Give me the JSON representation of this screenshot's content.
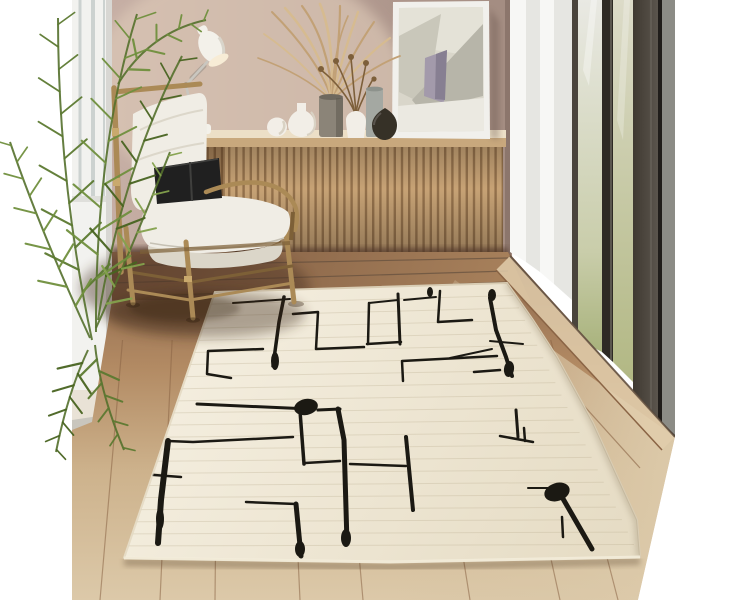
{
  "meta": {
    "alt": "Interior product photo: cream rug with black abstract line pattern on wood floor, rattan armchair with white cushions and black pillow, slatted oak sideboard with vases, dried pampas grass, leaning abstract art frame, desk lamp, palm plant, and floor-to-ceiling glass doors"
  },
  "palette": {
    "band": "#ffffff",
    "wall1": "#c9b2a8",
    "wall2": "#b59d93",
    "wall3": "#a48d82",
    "wallGlow": "#decab8",
    "pillar": "#f2f2ef",
    "pillarShade": "#d8d7d3",
    "mullion": "#ccd2d0",
    "baseboard": "#e6ddd0",
    "slatLight": "#cfa97a",
    "slatDark": "#9a764f",
    "counterTop": "#ecdfc7",
    "counterEdge": "#c8a87d",
    "boardShadow": "#53392a",
    "floorA": "#8a654a",
    "floorB": "#b28a63",
    "floorC": "#cdb28c",
    "floorD": "#dcc9a9",
    "backA": "#7c5940",
    "backB": "#a9825c",
    "seam": "#8a6445",
    "seamDark": "#59483a",
    "track": "#e0cdab",
    "rugA": "#f4eedf",
    "rugB": "#e5dbc3",
    "rugEdge": "#d9cdb4",
    "rugPile": "#f4eedd",
    "ink": "#1b1913",
    "weave": "#b9ac8e",
    "curtain1": "#f7f7f5",
    "curtain2": "#e6e6e2",
    "frameDark": "#2e2a24",
    "frameMid": "#4a443c",
    "frameLight": "#6e6960",
    "glass1a": "#e9e9e3",
    "glass1b": "#a9b37d",
    "glass2a": "#dcdbc8",
    "glass2b": "#b2b884",
    "panelA": "#3f3931",
    "panelB": "#5b554d",
    "grayStrip": "#8c8c86",
    "blackLine": "#201d1a",
    "rattan": "#ab8a56",
    "rattanDark": "#7d6037",
    "binding": "#c9a96d",
    "cushion": "#f0ede5",
    "cushionShade": "#dbd6c9",
    "pillowBlack": "#202020",
    "pillowHi": "#3f3f3d",
    "leaf1": "#5c7a31",
    "leaf2": "#70903e",
    "leaf3": "#486420",
    "leaf4": "#84a24d",
    "stemGreen": "#54702c",
    "lampShade": "#f3f1ea",
    "lampShadeShade": "#d9d5cb",
    "lampInner": "#f7ecd6",
    "lampArm": "#c9c6bf",
    "lampArmDark": "#8e8a82",
    "artFrame": "#f1f0ec",
    "artBg": "#d9d6ca",
    "artLight": "#e4e2d7",
    "artGray": "#b7b5a9",
    "artGray2": "#c9c7ba",
    "artLav": "#a39aab",
    "artLavDark": "#877f92",
    "artWhite": "#ebe9e1",
    "vaseWhite": "#f2eee7",
    "vaseWhiteShade": "#d9d2c4",
    "vaseGray": "#8b8478",
    "vaseGrayTop": "#6e685e",
    "vaseBlue": "#a4a8a2",
    "vaseBlueTop": "#8d928c",
    "vaseDark": "#363127",
    "vaseDarkHi": "#5a554e",
    "pampas": "#c2a176",
    "pampasLight": "#d6bb90",
    "stemBrown": "#7d5f3a"
  },
  "rug": {
    "corners": {
      "tl": [
        215,
        292
      ],
      "tr": [
        507,
        283
      ],
      "br": [
        640,
        557
      ],
      "bl": [
        124,
        558
      ]
    },
    "pattern": {
      "lines": [
        {
          "w": 2,
          "pts": [
            [
              233,
              303
            ],
            [
              290,
              299
            ]
          ]
        },
        {
          "w": 3.5,
          "pts": [
            [
              284,
              297
            ],
            [
              279,
              322
            ],
            [
              273,
              366
            ]
          ]
        },
        {
          "w": 2.5,
          "pts": [
            [
              293,
              314
            ],
            [
              318,
              312
            ],
            [
              316,
              349
            ],
            [
              364,
              347
            ]
          ]
        },
        {
          "w": 2.5,
          "pts": [
            [
              369,
              303
            ],
            [
              368,
              344
            ]
          ]
        },
        {
          "w": 2,
          "pts": [
            [
              369,
              303
            ],
            [
              398,
              300
            ]
          ]
        },
        {
          "w": 3,
          "pts": [
            [
              398,
              294
            ],
            [
              400,
              344
            ]
          ]
        },
        {
          "w": 2.5,
          "pts": [
            [
              367,
              344
            ],
            [
              401,
              342
            ]
          ]
        },
        {
          "w": 2,
          "pts": [
            [
              404,
              300
            ],
            [
              436,
              297
            ]
          ]
        },
        {
          "w": 2.5,
          "pts": [
            [
              440,
              291
            ],
            [
              438,
              322
            ],
            [
              472,
              320
            ]
          ]
        },
        {
          "w": 4,
          "pts": [
            [
              490,
              298
            ],
            [
              496,
              330
            ],
            [
              506,
              357
            ],
            [
              512,
              376
            ]
          ]
        },
        {
          "w": 2.5,
          "pts": [
            [
              474,
              372
            ],
            [
              500,
              370
            ]
          ]
        },
        {
          "w": 2,
          "pts": [
            [
              450,
              358
            ],
            [
              492,
              349
            ]
          ]
        },
        {
          "w": 2,
          "pts": [
            [
              490,
              341
            ],
            [
              523,
              344
            ]
          ]
        },
        {
          "w": 2.5,
          "pts": [
            [
              403,
              381
            ],
            [
              402,
              361
            ],
            [
              497,
              356
            ]
          ]
        },
        {
          "w": 2.5,
          "pts": [
            [
              263,
              349
            ],
            [
              208,
              351
            ],
            [
              207,
              374
            ],
            [
              231,
              378
            ]
          ]
        },
        {
          "w": 3,
          "pts": [
            [
              197,
              404
            ],
            [
              310,
              409
            ]
          ]
        },
        {
          "w": 3,
          "pts": [
            [
              318,
              410
            ],
            [
              340,
              409
            ]
          ]
        },
        {
          "w": 5,
          "pts": [
            [
              338,
              409
            ],
            [
              344,
              440
            ],
            [
              347,
              543
            ]
          ]
        },
        {
          "w": 3.5,
          "pts": [
            [
              300,
              411
            ],
            [
              304,
              464
            ]
          ]
        },
        {
          "w": 2.5,
          "pts": [
            [
              305,
              463
            ],
            [
              340,
              461
            ]
          ]
        },
        {
          "w": 2.5,
          "pts": [
            [
              168,
              441
            ],
            [
              193,
              442
            ],
            [
              293,
              437
            ]
          ]
        },
        {
          "w": 6,
          "pts": [
            [
              168,
              441
            ],
            [
              161,
              500
            ],
            [
              158,
              543
            ]
          ]
        },
        {
          "w": 2.5,
          "pts": [
            [
              142,
              486
            ],
            [
              141,
              474
            ],
            [
              181,
              477
            ]
          ]
        },
        {
          "w": 2.5,
          "pts": [
            [
              246,
              502
            ],
            [
              296,
              504
            ]
          ]
        },
        {
          "w": 5,
          "pts": [
            [
              296,
              504
            ],
            [
              301,
              556
            ]
          ]
        },
        {
          "w": 2.5,
          "pts": [
            [
              350,
              464
            ],
            [
              406,
              466
            ]
          ]
        },
        {
          "w": 4,
          "pts": [
            [
              406,
              437
            ],
            [
              413,
              510
            ]
          ]
        },
        {
          "w": 2.5,
          "pts": [
            [
              524,
              428
            ],
            [
              525,
              441
            ]
          ]
        },
        {
          "w": 2.5,
          "pts": [
            [
              500,
              436
            ],
            [
              533,
              442
            ]
          ]
        },
        {
          "w": 3,
          "pts": [
            [
              516,
              410
            ],
            [
              518,
              437
            ]
          ]
        },
        {
          "w": 5,
          "pts": [
            [
              562,
              497
            ],
            [
              592,
              549
            ]
          ]
        },
        {
          "w": 2,
          "pts": [
            [
              528,
              488
            ],
            [
              548,
              488
            ]
          ]
        },
        {
          "w": 2.5,
          "pts": [
            [
              562,
              517
            ],
            [
              563,
              537
            ]
          ]
        }
      ],
      "blobs": [
        {
          "cx": 275,
          "cy": 361,
          "rx": 4,
          "ry": 9,
          "rot": 0
        },
        {
          "cx": 509,
          "cy": 369,
          "rx": 5,
          "ry": 8,
          "rot": 8
        },
        {
          "cx": 492,
          "cy": 295,
          "rx": 4,
          "ry": 6,
          "rot": 0
        },
        {
          "cx": 306,
          "cy": 407,
          "rx": 12,
          "ry": 8,
          "rot": -12
        },
        {
          "cx": 346,
          "cy": 538,
          "rx": 5,
          "ry": 9,
          "rot": 0
        },
        {
          "cx": 160,
          "cy": 519,
          "rx": 4,
          "ry": 11,
          "rot": 0
        },
        {
          "cx": 300,
          "cy": 549,
          "rx": 5,
          "ry": 8,
          "rot": 0
        },
        {
          "cx": 557,
          "cy": 492,
          "rx": 13,
          "ry": 9,
          "rot": -18
        },
        {
          "cx": 430,
          "cy": 292,
          "rx": 3,
          "ry": 5,
          "rot": 0
        }
      ]
    },
    "weave_count": 22
  },
  "floor": {
    "seam_xs": [
      100,
      160,
      215,
      300,
      363,
      470,
      560,
      618
    ],
    "vanishing_point": [
      230,
      -900
    ],
    "back_seams": [
      [
        112,
        266,
        508,
        258
      ],
      [
        112,
        283,
        508,
        271
      ],
      [
        150,
        296,
        508,
        282
      ]
    ]
  }
}
